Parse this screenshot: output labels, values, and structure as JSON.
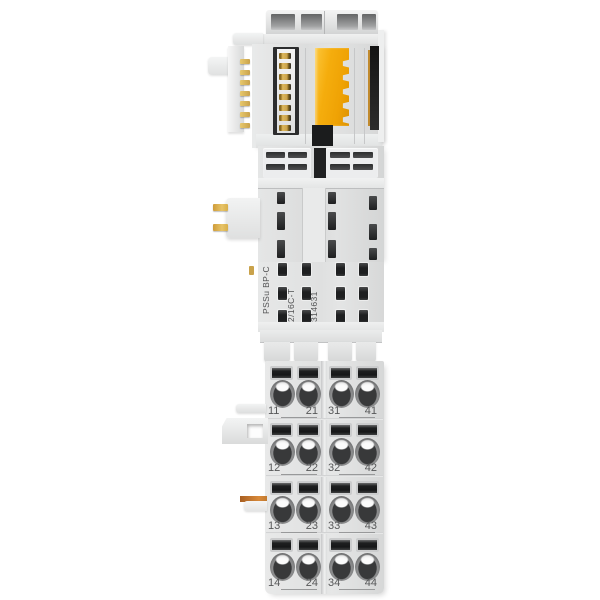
{
  "product_label": {
    "line1": "PSSu BP-C",
    "line2": "2/16C-T",
    "line3": "314631"
  },
  "terminals": {
    "rows": [
      [
        "11",
        "21",
        "31",
        "41"
      ],
      [
        "12",
        "22",
        "32",
        "42"
      ],
      [
        "13",
        "23",
        "33",
        "43"
      ],
      [
        "14",
        "24",
        "34",
        "44"
      ]
    ]
  },
  "counts": {
    "bus_contact_pins": 8,
    "side_pins": 7,
    "mid_pins": 2,
    "label_contact_columns": 4,
    "label_contact_rows": 3
  },
  "colors": {
    "background": "#ffffff",
    "coding_yellow": "#f5ad0d",
    "contact_gold": "#c9a24b",
    "slot_dark": "#1e1f20",
    "pcb_black": "#1b1c1d",
    "label_text": "#505152"
  }
}
